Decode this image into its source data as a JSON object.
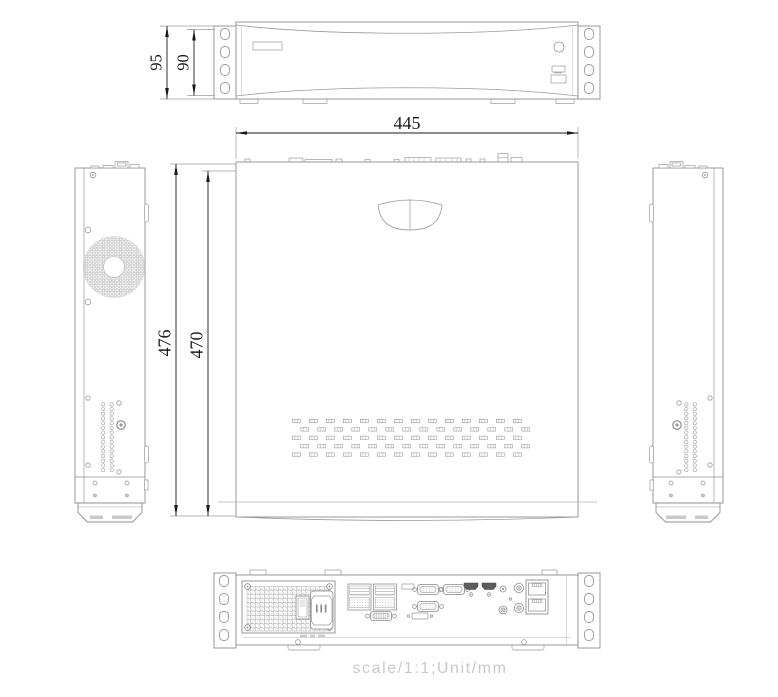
{
  "drawing": {
    "footer_note": "scale/1:1;Unit/mm",
    "dimensions": {
      "front_height_overall_mm": "95",
      "front_height_body_mm": "90",
      "chassis_width_mm": "445",
      "chassis_depth_overall_mm": "476",
      "chassis_depth_body_mm": "470"
    },
    "colors": {
      "outline": "#8f8f8f",
      "dimension_ink": "#1a1a1a",
      "footer_text": "#c9c9c9",
      "background": "#ffffff"
    }
  }
}
